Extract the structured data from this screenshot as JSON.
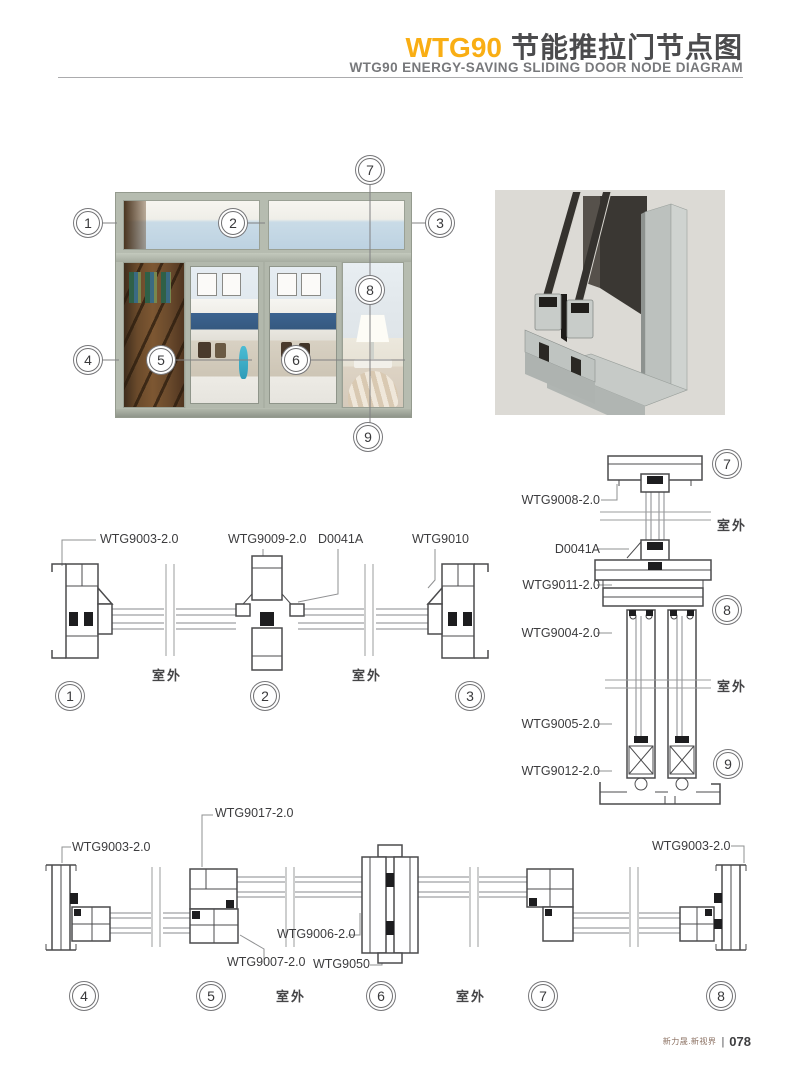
{
  "header": {
    "model": "WTG90",
    "title_cn": "节能推拉门节点图",
    "title_en": "WTG90 ENERGY-SAVING SLIDING DOOR NODE DIAGRAM"
  },
  "common": {
    "outdoor": "室外"
  },
  "callouts": [
    "1",
    "2",
    "3",
    "4",
    "5",
    "6",
    "7",
    "8",
    "9"
  ],
  "sections": {
    "top": {
      "labels": [
        "WTG9003-2.0",
        "WTG9009-2.0",
        "D0041A",
        "WTG9010"
      ]
    },
    "right": {
      "labels": [
        "WTG9008-2.0",
        "D0041A",
        "WTG9011-2.0",
        "WTG9004-2.0",
        "WTG9005-2.0",
        "WTG9012-2.0"
      ]
    },
    "bottom": {
      "labels": [
        "WTG9017-2.0",
        "WTG9003-2.0",
        "WTG9006-2.0",
        "WTG9007-2.0",
        "WTG9050",
        "WTG9003-2.0"
      ]
    }
  },
  "colors": {
    "accent": "#f9ae14",
    "line": "#4b4b4d",
    "frame": "#b6bcb0"
  },
  "footer": {
    "brand": "新力晟.新视界",
    "divider": "|",
    "page": "078"
  }
}
